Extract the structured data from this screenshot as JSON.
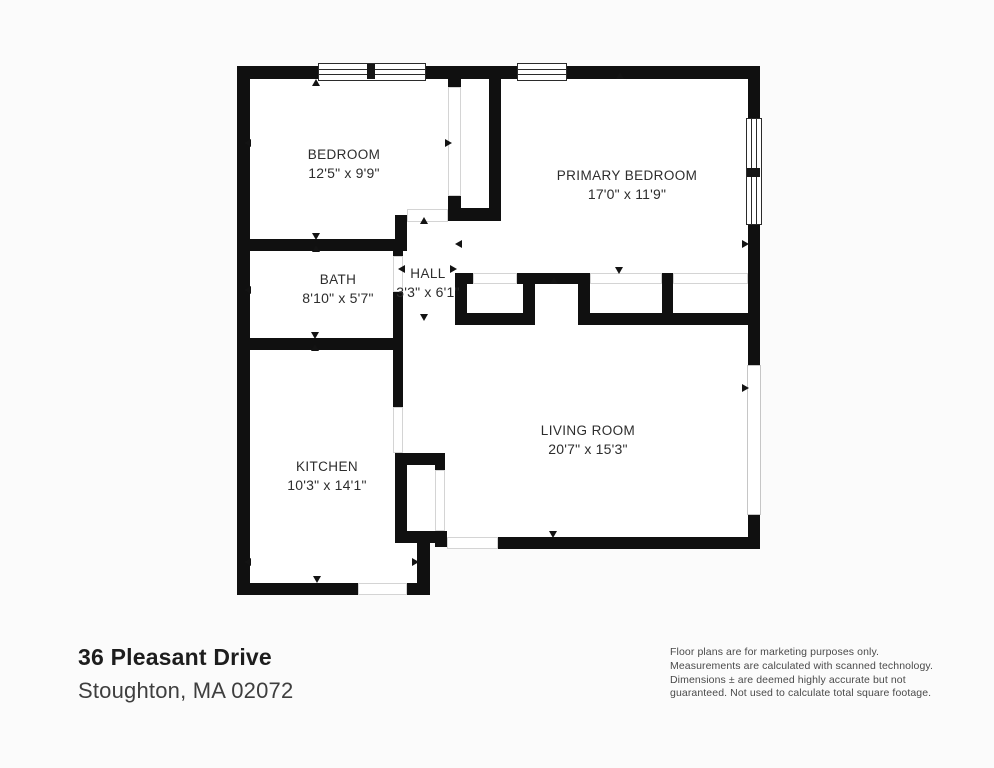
{
  "address": {
    "line1": "36 Pleasant Drive",
    "line2": "Stoughton, MA 02072"
  },
  "disclaimer": [
    "Floor plans are for marketing purposes only.",
    "Measurements are calculated with scanned technology.",
    "Dimensions ± are deemed highly accurate but not",
    "guaranteed. Not used to calculate total square footage."
  ],
  "rooms": {
    "bedroom": {
      "name": "BEDROOM",
      "dims": "12'5\" x 9'9\""
    },
    "primary_bedroom": {
      "name": "PRIMARY BEDROOM",
      "dims": "17'0\" x 11'9\""
    },
    "bath": {
      "name": "BATH",
      "dims": "8'10\" x 5'7\""
    },
    "hall": {
      "name": "HALL",
      "dims": "3'3\" x 6'1\""
    },
    "kitchen": {
      "name": "KITCHEN",
      "dims": "10'3\" x 14'1\""
    },
    "living_room": {
      "name": "LIVING ROOM",
      "dims": "20'7\" x 15'3\""
    }
  },
  "colors": {
    "wall": "#101010",
    "background": "#fbfbfb",
    "room_fill": "#ffffff"
  }
}
